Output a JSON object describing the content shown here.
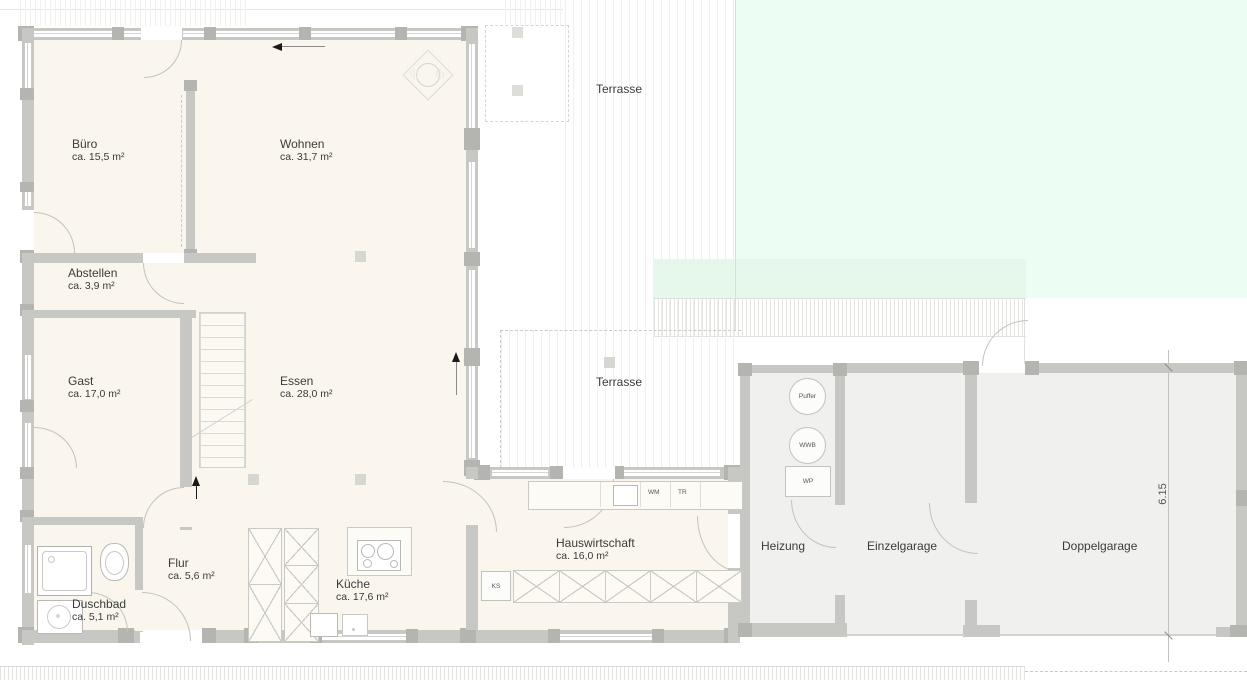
{
  "rooms": [
    {
      "name": "Büro",
      "area": "ca. 15,5 m²"
    },
    {
      "name": "Wohnen",
      "area": "ca. 31,7 m²"
    },
    {
      "name": "Abstellen",
      "area": "ca. 3,9 m²"
    },
    {
      "name": "Gast",
      "area": "ca. 17,0 m²"
    },
    {
      "name": "Essen",
      "area": "ca. 28,0 m²"
    },
    {
      "name": "Flur",
      "area": "ca. 5,6 m²"
    },
    {
      "name": "Duschbad",
      "area": "ca. 5,1 m²"
    },
    {
      "name": "Küche",
      "area": "ca. 17,6 m²"
    },
    {
      "name": "Hauswirtschaft",
      "area": "ca. 16,0 m²"
    },
    {
      "name": "Heizung",
      "area": ""
    },
    {
      "name": "Einzelgarage",
      "area": ""
    },
    {
      "name": "Doppelgarage",
      "area": ""
    }
  ],
  "outdoor": {
    "terrasse_top": "Terrasse",
    "terrasse_mid": "Terrasse"
  },
  "equipment": {
    "puffer": "Puffer",
    "wwb": "WWB",
    "wp": "WP",
    "wm": "WM",
    "tr": "TR",
    "ks": "KS"
  },
  "dimensions": {
    "garage_depth": "6.15"
  },
  "colors": {
    "room_fill": "#faf6ed",
    "garage_fill": "#f0f0ef",
    "wall": "#c7c7c3",
    "lawn": "#ecfdf4",
    "lawn_band": "#e6f8ec",
    "text": "#3b3b3b"
  }
}
